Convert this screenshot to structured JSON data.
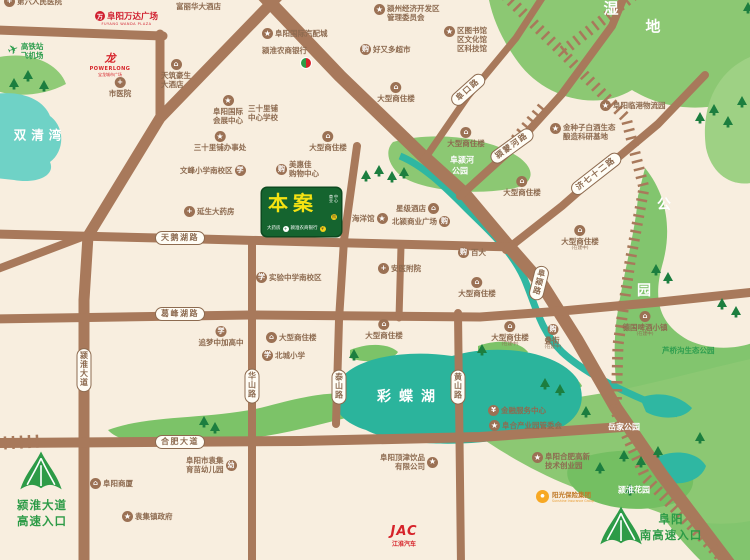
{
  "palette": {
    "background": "#f8eedf",
    "road": "#a8795b",
    "road_label": "#8d6b50",
    "park_green": "#8cc873",
    "lake_teal": "#2bb49c",
    "bay_teal": "#6fd2c6",
    "site_green": "#15642f",
    "site_text_yellow": "#f6e312",
    "highway_green": "#2d9b47",
    "brand_red": "#d6232a",
    "sunshine_orange": "#f7a823"
  },
  "site": {
    "label": "本案",
    "side_lines": [
      "商业",
      "中心"
    ],
    "side_icon": "购",
    "bottom_left": "大药房",
    "bottom_right": "颍淮农商银行",
    "bottom_icons": [
      "+",
      "¥"
    ]
  },
  "area_labels": [
    {
      "text": "湿",
      "x": 611,
      "y": 8,
      "fs": 15
    },
    {
      "text": "地",
      "x": 653,
      "y": 26,
      "fs": 15
    },
    {
      "text": "双清湾",
      "x": 40,
      "y": 134,
      "fs": 12.5,
      "ls": 5
    },
    {
      "text": "阜颍河",
      "x": 462,
      "y": 160,
      "fs": 8
    },
    {
      "text": "公园",
      "x": 460,
      "y": 171,
      "fs": 8
    },
    {
      "text": "公",
      "x": 664,
      "y": 204,
      "fs": 14
    },
    {
      "text": "园",
      "x": 644,
      "y": 290,
      "fs": 14
    },
    {
      "text": "彩蝶湖",
      "x": 410,
      "y": 396,
      "fs": 14,
      "ls": 8
    },
    {
      "text": "岳家公园",
      "x": 624,
      "y": 427,
      "fs": 8
    },
    {
      "text": "颍淮花园",
      "x": 634,
      "y": 490,
      "fs": 8
    }
  ],
  "road_pills": [
    {
      "label": "天鹅湖路",
      "x": 180,
      "y": 238
    },
    {
      "label": "葛峰湖路",
      "x": 180,
      "y": 314
    },
    {
      "label": "合肥大道",
      "x": 180,
      "y": 442
    },
    {
      "label": "阜口路",
      "x": 468,
      "y": 90,
      "rot": -42
    },
    {
      "label": "颍蒙河路",
      "x": 512,
      "y": 146,
      "rot": -36
    },
    {
      "label": "济七十二路",
      "x": 596,
      "y": 174,
      "rot": -38
    },
    {
      "label": "颍淮大道",
      "x": 84,
      "y": 370,
      "vert": true
    },
    {
      "label": "华山路",
      "x": 252,
      "y": 386,
      "vert": true
    },
    {
      "label": "泰山路",
      "x": 339,
      "y": 387,
      "vert": true
    },
    {
      "label": "黄山路",
      "x": 458,
      "y": 387,
      "vert": true
    },
    {
      "label": "阜颍路",
      "x": 539,
      "y": 283,
      "vert": true,
      "rot": 14
    }
  ],
  "pois": [
    {
      "x": 4,
      "y": -4,
      "icon": "hospital",
      "lines": [
        "第六人民医院"
      ]
    },
    {
      "x": 176,
      "y": 2,
      "lines": [
        "富丽华大酒店"
      ]
    },
    {
      "x": 374,
      "y": 4,
      "icon": "star",
      "lines": [
        "颍州经济开发区",
        "管理委员会"
      ],
      "top": true
    },
    {
      "x": 262,
      "y": 28,
      "icon": "star",
      "lines": [
        "阜阳国际汽配城"
      ]
    },
    {
      "x": 262,
      "y": 46,
      "lines": [
        "颍淮农商银行"
      ]
    },
    {
      "x": 360,
      "y": 44,
      "icon": "shop",
      "lines": [
        "好又多超市"
      ]
    },
    {
      "x": 444,
      "y": 26,
      "icon": "star",
      "lines": [
        "区图书馆",
        "区文化馆",
        "区科技馆"
      ],
      "top": true
    },
    {
      "x": 8,
      "y": 42,
      "icon": "plane",
      "lines": [
        "高铁站",
        "飞机场"
      ],
      "cls": "green"
    },
    {
      "cx": 120,
      "y": 77,
      "icon": "hospital",
      "ip": "t",
      "lines": [
        "市医院"
      ]
    },
    {
      "cx": 176,
      "y": 59,
      "icon": "hotel",
      "ip": "t",
      "lines": [
        "天筑豪生",
        "大酒店"
      ]
    },
    {
      "cx": 228,
      "y": 95,
      "icon": "star",
      "ip": "t",
      "lines": [
        "阜阳国际",
        "会展中心"
      ]
    },
    {
      "x": 248,
      "y": 104,
      "lines": [
        "三十里铺",
        "中心学校"
      ]
    },
    {
      "cx": 220,
      "y": 131,
      "icon": "star",
      "ip": "t",
      "lines": [
        "三十里铺办事处"
      ]
    },
    {
      "x": 180,
      "y": 165,
      "icon": "school",
      "ip": "r",
      "lines": [
        "文峰小学南校区"
      ]
    },
    {
      "x": 184,
      "y": 206,
      "icon": "hospital",
      "lines": [
        "延生大药房"
      ]
    },
    {
      "x": 600,
      "y": 100,
      "icon": "star",
      "lines": [
        "阜阳临港物流园"
      ]
    },
    {
      "x": 550,
      "y": 123,
      "icon": "star",
      "lines": [
        "金种子白酒生态",
        "酿造科研基地"
      ],
      "top": true
    },
    {
      "cx": 396,
      "y": 82,
      "icon": "building",
      "ip": "t",
      "lines": [
        "大型商住楼"
      ]
    },
    {
      "cx": 328,
      "y": 131,
      "icon": "building",
      "ip": "t",
      "lines": [
        "大型商住楼"
      ]
    },
    {
      "cx": 466,
      "y": 127,
      "icon": "building",
      "ip": "t",
      "lines": [
        "大型商住楼"
      ]
    },
    {
      "cx": 522,
      "y": 176,
      "icon": "building",
      "ip": "t",
      "lines": [
        "大型商住楼"
      ]
    },
    {
      "cx": 580,
      "y": 225,
      "icon": "building",
      "ip": "t",
      "lines": [
        "大型商住楼"
      ],
      "sub": "(在建中)"
    },
    {
      "x": 276,
      "y": 160,
      "icon": "shop",
      "lines": [
        "美惠佳",
        "购物中心"
      ]
    },
    {
      "x": 352,
      "y": 213,
      "icon": "star",
      "ip": "r",
      "lines": [
        "海洋馆"
      ]
    },
    {
      "x": 396,
      "y": 203,
      "icon": "building",
      "ip": "r",
      "lines": [
        "星级酒店"
      ]
    },
    {
      "x": 392,
      "y": 216,
      "icon": "shop",
      "ip": "r",
      "lines": [
        "北颍商业广场"
      ]
    },
    {
      "x": 458,
      "y": 247,
      "icon": "shop",
      "lines": [
        "百大"
      ]
    },
    {
      "x": 256,
      "y": 272,
      "icon": "school",
      "lines": [
        "实验中学南校区"
      ]
    },
    {
      "x": 378,
      "y": 263,
      "icon": "hospital",
      "lines": [
        "安医附院"
      ]
    },
    {
      "cx": 477,
      "y": 277,
      "icon": "building",
      "ip": "t",
      "lines": [
        "大型商住楼"
      ]
    },
    {
      "cx": 221,
      "y": 326,
      "icon": "school",
      "ip": "t",
      "lines": [
        "追梦中加高中"
      ]
    },
    {
      "x": 266,
      "y": 332,
      "icon": "building",
      "lines": [
        "大型商住楼"
      ]
    },
    {
      "x": 262,
      "y": 350,
      "icon": "school",
      "lines": [
        "北城小学"
      ]
    },
    {
      "cx": 384,
      "y": 319,
      "icon": "building",
      "ip": "t",
      "lines": [
        "大型商住楼"
      ]
    },
    {
      "cx": 510,
      "y": 321,
      "icon": "building",
      "ip": "t",
      "lines": [
        "大型商住楼"
      ],
      "sub": "(在建中)"
    },
    {
      "cx": 553,
      "y": 324,
      "icon": "shop",
      "ip": "t",
      "lines": [
        "叠街"
      ],
      "sub": "(在建中)"
    },
    {
      "cx": 645,
      "y": 311,
      "icon": "building",
      "ip": "t",
      "lines": [
        "德国啤酒小镇"
      ],
      "sub": "(在建中)"
    },
    {
      "x": 662,
      "y": 346,
      "lines": [
        "芦桥沟生态公园"
      ],
      "cls": "green"
    },
    {
      "x": 488,
      "y": 405,
      "icon": "bank",
      "lines": [
        "金融服务中心"
      ]
    },
    {
      "x": 489,
      "y": 420,
      "icon": "star",
      "lines": [
        "阜合产业园管委会"
      ]
    },
    {
      "x": 532,
      "y": 452,
      "icon": "star",
      "lines": [
        "阜阳合肥高新",
        "技术创业园"
      ],
      "top": true
    },
    {
      "x": 380,
      "y": 453,
      "icon": "star",
      "ip": "r",
      "lines": [
        "阜阳顶津饮品",
        "有限公司"
      ],
      "ra": true
    },
    {
      "x": 90,
      "y": 478,
      "icon": "building",
      "lines": [
        "阜阳商厦"
      ]
    },
    {
      "x": 122,
      "y": 511,
      "icon": "star",
      "lines": [
        "袁集镇政府"
      ]
    },
    {
      "x": 186,
      "y": 456,
      "icon": "kindergarten",
      "ip": "r",
      "lines": [
        "阜阳市袁集",
        "育苗幼儿园"
      ]
    }
  ],
  "logos": {
    "wanda": {
      "x": 95,
      "y": 10,
      "icon": "万",
      "title": "阜阳万达广场",
      "subtitle": "FUYANG WANDA PLAZA"
    },
    "powerlong": {
      "cx": 110,
      "y": 50,
      "icon": "龙",
      "title": "POWERLONG",
      "subtitle": "宝龙城市广场"
    },
    "bank_mark": {
      "x": 300,
      "y": 57
    },
    "jac": {
      "cx": 404,
      "y": 524,
      "title": "JAC",
      "subtitle": "江淮汽车"
    },
    "sunshine": {
      "x": 536,
      "y": 489,
      "title": "阳光保险集团",
      "subtitle": "Sunshine Insurance Group"
    }
  },
  "highway_entrances": [
    {
      "id": "sw",
      "lines": [
        "颍淮大道",
        "高速入口"
      ],
      "icon_x": 18,
      "icon_y": 450,
      "cx": 42,
      "ty": 497,
      "fs": 11.5
    },
    {
      "id": "se",
      "lines": [
        "阜阳",
        "南高速入口"
      ],
      "icon_x": 598,
      "icon_y": 505,
      "cx": 671,
      "ty": 511,
      "fs": 11.5
    }
  ],
  "icon_glyphs": {
    "star": "★",
    "hospital": "+",
    "building": "⌂",
    "hotel": "⌂",
    "school": "学",
    "shop": "购",
    "bank": "¥",
    "kindergarten": "幼",
    "plane": "✈"
  }
}
